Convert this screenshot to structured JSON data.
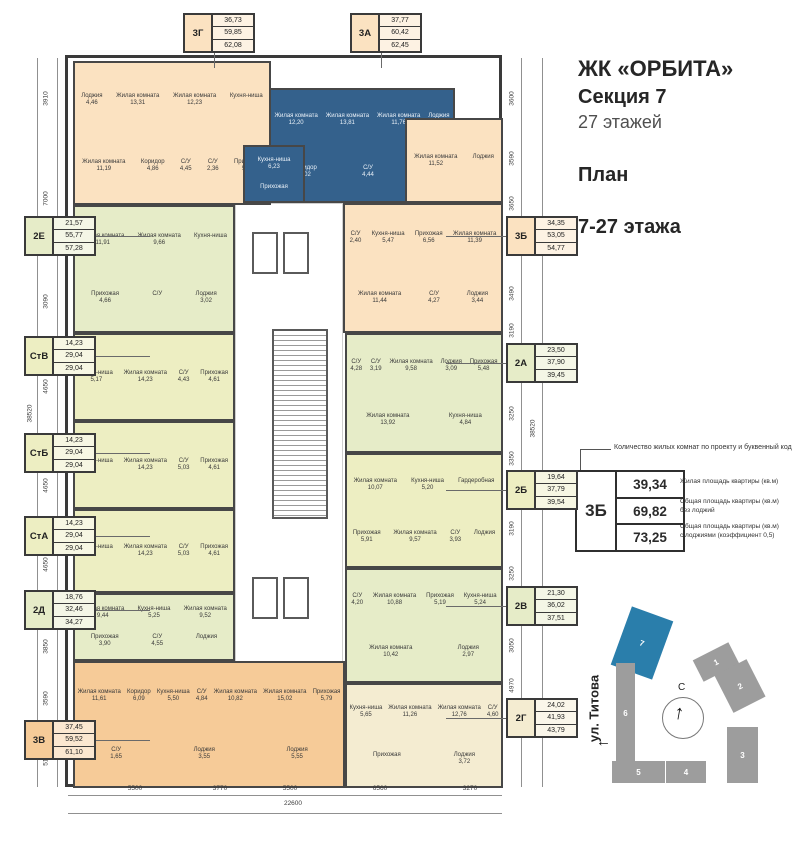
{
  "header": {
    "project": "ЖК «ОРБИТА»",
    "section": "Секция 7",
    "floors": "27 этажей",
    "plan_line1": "План",
    "plan_line2": "7-27 этажа"
  },
  "legend": {
    "note": "Количество жилых комнат по проекту и буквенный код",
    "code": "3Б",
    "rows": [
      {
        "value": "39,34",
        "desc": "Жилая площадь квартиры (кв.м)"
      },
      {
        "value": "69,82",
        "desc": "Общая площадь квартиры (кв.м)\nбез лоджий"
      },
      {
        "value": "73,25",
        "desc": "Общая площадь квартиры (кв.м)\nс лоджиями (коэффициент 0,5)"
      }
    ]
  },
  "colors": {
    "peach": "#fbe2c1",
    "blue": "#34618c",
    "green": "#e6ecc8",
    "studio": "#edeec2",
    "orange": "#f6cb98",
    "cream": "#f4ecd1"
  },
  "floor_plan": {
    "unit_labels": [
      {
        "code": "3Г",
        "values": [
          "36,73",
          "59,85",
          "62,08"
        ],
        "x": 183,
        "y": 13,
        "side": "top",
        "color": "peach"
      },
      {
        "code": "3А",
        "values": [
          "37,77",
          "60,42",
          "62,45"
        ],
        "x": 350,
        "y": 13,
        "side": "top",
        "color": "peach"
      },
      {
        "code": "2Е",
        "values": [
          "21,57",
          "55,77",
          "57,28"
        ],
        "x": 24,
        "y": 216,
        "side": "left",
        "color": "green"
      },
      {
        "code": "СтВ",
        "values": [
          "14,23",
          "29,04",
          "29,04"
        ],
        "x": 24,
        "y": 336,
        "side": "left",
        "color": "studio"
      },
      {
        "code": "СтБ",
        "values": [
          "14,23",
          "29,04",
          "29,04"
        ],
        "x": 24,
        "y": 433,
        "side": "left",
        "color": "studio"
      },
      {
        "code": "СтА",
        "values": [
          "14,23",
          "29,04",
          "29,04"
        ],
        "x": 24,
        "y": 516,
        "side": "left",
        "color": "studio"
      },
      {
        "code": "2Д",
        "values": [
          "18,76",
          "32,46",
          "34,27"
        ],
        "x": 24,
        "y": 590,
        "side": "left",
        "color": "green"
      },
      {
        "code": "3В",
        "values": [
          "37,45",
          "59,52",
          "61,10"
        ],
        "x": 24,
        "y": 720,
        "side": "left",
        "color": "orange"
      },
      {
        "code": "3Б",
        "values": [
          "34,35",
          "53,05",
          "54,77"
        ],
        "x": 506,
        "y": 216,
        "side": "right",
        "color": "peach"
      },
      {
        "code": "2А",
        "values": [
          "23,50",
          "37,90",
          "39,45"
        ],
        "x": 506,
        "y": 343,
        "side": "right",
        "color": "green"
      },
      {
        "code": "2Б",
        "values": [
          "19,64",
          "37,79",
          "39,54"
        ],
        "x": 506,
        "y": 470,
        "side": "right",
        "color": "studio"
      },
      {
        "code": "2В",
        "values": [
          "21,30",
          "36,02",
          "37,51"
        ],
        "x": 506,
        "y": 586,
        "side": "right",
        "color": "green"
      },
      {
        "code": "2Г",
        "values": [
          "24,02",
          "41,93",
          "43,79"
        ],
        "x": 506,
        "y": 698,
        "side": "right",
        "color": "cream"
      }
    ],
    "apartments": [
      {
        "code": "3Г",
        "color": "peach",
        "x": 5,
        "y": 3,
        "w": 198,
        "h": 144,
        "rooms": [
          {
            "n": "Лоджия",
            "a": "4,46"
          },
          {
            "n": "Жилая комната",
            "a": "13,31"
          },
          {
            "n": "Жилая комната",
            "a": "12,23"
          },
          {
            "n": "Кухня-ниша",
            "a": ""
          },
          {
            "n": "Жилая комната",
            "a": "11,19"
          },
          {
            "n": "Коридор",
            "a": "4,86"
          },
          {
            "n": "С/У",
            "a": "4,45"
          },
          {
            "n": "С/У",
            "a": "2,36"
          },
          {
            "n": "Прихожая",
            "a": "5,81"
          }
        ]
      },
      {
        "code": "3А",
        "color": "blue",
        "x": 201,
        "y": 30,
        "w": 186,
        "h": 115,
        "rooms": [
          {
            "n": "Жилая комната",
            "a": "12,20"
          },
          {
            "n": "Жилая комната",
            "a": "13,81"
          },
          {
            "n": "Жилая комната",
            "a": "11,76"
          },
          {
            "n": "Лоджия",
            "a": "4,01"
          },
          {
            "n": "Коридор",
            "a": "6,02"
          },
          {
            "n": "С/У",
            "a": "4,44"
          },
          {
            "n": "С/У",
            "a": "2,37"
          }
        ]
      },
      {
        "code": "3А",
        "color": "blue",
        "x": 175,
        "y": 87,
        "w": 62,
        "h": 58,
        "rooms": [
          {
            "n": "Кухня-ниша",
            "a": "6,23"
          },
          {
            "n": "Прихожая",
            "a": ""
          }
        ]
      },
      {
        "code": "3Б",
        "color": "peach",
        "x": 337,
        "y": 60,
        "w": 98,
        "h": 85,
        "rooms": [
          {
            "n": "Жилая комната",
            "a": "11,52"
          },
          {
            "n": "Лоджия",
            "a": ""
          }
        ]
      },
      {
        "code": "3Б",
        "color": "peach",
        "x": 275,
        "y": 145,
        "w": 160,
        "h": 130,
        "rooms": [
          {
            "n": "С/У",
            "a": "2,40"
          },
          {
            "n": "Кухня-ниша",
            "a": "5,47"
          },
          {
            "n": "Прихожая",
            "a": "6,56"
          },
          {
            "n": "Жилая комната",
            "a": "11,39"
          },
          {
            "n": "Жилая комната",
            "a": "11,44"
          },
          {
            "n": "С/У",
            "a": "4,27"
          },
          {
            "n": "Лоджия",
            "a": "3,44"
          }
        ]
      },
      {
        "code": "2Е",
        "color": "green",
        "x": 5,
        "y": 147,
        "w": 162,
        "h": 128,
        "rooms": [
          {
            "n": "Жилая комната",
            "a": "11,91"
          },
          {
            "n": "Жилая комната",
            "a": "9,66"
          },
          {
            "n": "Кухня-ниша",
            "a": ""
          },
          {
            "n": "Прихожая",
            "a": "4,66"
          },
          {
            "n": "С/У",
            "a": ""
          },
          {
            "n": "Лоджия",
            "a": "3,02"
          }
        ]
      },
      {
        "code": "СтВ",
        "color": "studio",
        "x": 5,
        "y": 275,
        "w": 162,
        "h": 88,
        "rooms": [
          {
            "n": "Кухня-ниша",
            "a": "5,17"
          },
          {
            "n": "Жилая комната",
            "a": "14,23"
          },
          {
            "n": "С/У",
            "a": "4,43"
          },
          {
            "n": "Прихожая",
            "a": "4,61"
          }
        ]
      },
      {
        "code": "СтБ",
        "color": "studio",
        "x": 5,
        "y": 363,
        "w": 162,
        "h": 88,
        "rooms": [
          {
            "n": "Кухня-ниша",
            "a": ""
          },
          {
            "n": "Жилая комната",
            "a": "14,23"
          },
          {
            "n": "С/У",
            "a": "5,03"
          },
          {
            "n": "Прихожая",
            "a": "4,61"
          }
        ]
      },
      {
        "code": "СтА",
        "color": "studio",
        "x": 5,
        "y": 451,
        "w": 162,
        "h": 84,
        "rooms": [
          {
            "n": "Кухня-ниша",
            "a": ""
          },
          {
            "n": "Жилая комната",
            "a": "14,23"
          },
          {
            "n": "С/У",
            "a": "5,03"
          },
          {
            "n": "Прихожая",
            "a": "4,61"
          }
        ]
      },
      {
        "code": "2Д",
        "color": "green",
        "x": 5,
        "y": 535,
        "w": 162,
        "h": 68,
        "rooms": [
          {
            "n": "Жилая комната",
            "a": "9,44"
          },
          {
            "n": "Кухня-ниша",
            "a": "5,25"
          },
          {
            "n": "Жилая комната",
            "a": "9,52"
          },
          {
            "n": "Прихожая",
            "a": "3,90"
          },
          {
            "n": "С/У",
            "a": "4,55"
          },
          {
            "n": "Лоджия",
            "a": ""
          }
        ]
      },
      {
        "code": "3В",
        "color": "orange",
        "x": 5,
        "y": 603,
        "w": 272,
        "h": 127,
        "rooms": [
          {
            "n": "Жилая комната",
            "a": "11,61"
          },
          {
            "n": "Коридор",
            "a": "6,09"
          },
          {
            "n": "Кухня-ниша",
            "a": "5,50"
          },
          {
            "n": "С/У",
            "a": "4,84"
          },
          {
            "n": "Жилая комната",
            "a": "10,82"
          },
          {
            "n": "Жилая комната",
            "a": "15,02"
          },
          {
            "n": "Прихожая",
            "a": "5,79"
          },
          {
            "n": "С/У",
            "a": "1,65"
          },
          {
            "n": "Лоджия",
            "a": "3,55"
          },
          {
            "n": "Лоджия",
            "a": "5,55"
          }
        ]
      },
      {
        "code": "2Г",
        "color": "cream",
        "x": 277,
        "y": 625,
        "w": 158,
        "h": 105,
        "rooms": [
          {
            "n": "Кухня-ниша",
            "a": "5,65"
          },
          {
            "n": "Жилая комната",
            "a": "11,26"
          },
          {
            "n": "Жилая комната",
            "a": "12,76"
          },
          {
            "n": "С/У",
            "a": "4,60"
          },
          {
            "n": "Прихожая",
            "a": ""
          },
          {
            "n": "Лоджия",
            "a": "3,72"
          }
        ]
      },
      {
        "code": "2В",
        "color": "green",
        "x": 277,
        "y": 510,
        "w": 158,
        "h": 115,
        "rooms": [
          {
            "n": "С/У",
            "a": "4,20"
          },
          {
            "n": "Жилая комната",
            "a": "10,88"
          },
          {
            "n": "Прихожая",
            "a": "5,19"
          },
          {
            "n": "Кухня-ниша",
            "a": "5,24"
          },
          {
            "n": "Жилая комната",
            "a": "10,42"
          },
          {
            "n": "Лоджия",
            "a": "2,97"
          }
        ]
      },
      {
        "code": "2Б",
        "color": "studio",
        "x": 277,
        "y": 395,
        "w": 158,
        "h": 115,
        "rooms": [
          {
            "n": "Жилая комната",
            "a": "10,07"
          },
          {
            "n": "Кухня-ниша",
            "a": "5,20"
          },
          {
            "n": "Гардеробная",
            "a": ""
          },
          {
            "n": "Прихожая",
            "a": "5,91"
          },
          {
            "n": "Жилая комната",
            "a": "9,57"
          },
          {
            "n": "С/У",
            "a": "3,93"
          },
          {
            "n": "Лоджия",
            "a": ""
          }
        ]
      },
      {
        "code": "2А",
        "color": "green",
        "x": 277,
        "y": 275,
        "w": 158,
        "h": 120,
        "rooms": [
          {
            "n": "С/У",
            "a": "4,28"
          },
          {
            "n": "С/У",
            "a": "3,19"
          },
          {
            "n": "Жилая комната",
            "a": "9,58"
          },
          {
            "n": "Лоджия",
            "a": "3,09"
          },
          {
            "n": "Прихожая",
            "a": "5,48"
          },
          {
            "n": "Жилая комната",
            "a": "13,92"
          },
          {
            "n": "Кухня-ниша",
            "a": "4,84"
          }
        ]
      }
    ],
    "dims": {
      "left": [
        {
          "v": "3910",
          "y": 100
        },
        {
          "v": "7000",
          "y": 200
        },
        {
          "v": "3090",
          "y": 303
        },
        {
          "v": "4650",
          "y": 388
        },
        {
          "v": "4650",
          "y": 487
        },
        {
          "v": "4650",
          "y": 566
        },
        {
          "v": "3850",
          "y": 648
        },
        {
          "v": "3590",
          "y": 700
        },
        {
          "v": "5190",
          "y": 760
        }
      ],
      "right": [
        {
          "v": "3600",
          "y": 100
        },
        {
          "v": "3590",
          "y": 160
        },
        {
          "v": "3650",
          "y": 205
        },
        {
          "v": "3490",
          "y": 295
        },
        {
          "v": "3190",
          "y": 332
        },
        {
          "v": "3250",
          "y": 415
        },
        {
          "v": "3350",
          "y": 460
        },
        {
          "v": "3190",
          "y": 530
        },
        {
          "v": "3250",
          "y": 575
        },
        {
          "v": "3050",
          "y": 647
        },
        {
          "v": "4970",
          "y": 687
        }
      ],
      "bottom": [
        {
          "v": "5500",
          "x": 135
        },
        {
          "v": "3770",
          "x": 220
        },
        {
          "v": "5500",
          "x": 290
        },
        {
          "v": "6560",
          "x": 380
        },
        {
          "v": "3270",
          "x": 470
        }
      ],
      "left_total": "38520",
      "right_total": "38520",
      "bottom_total": "22600"
    }
  },
  "site_plan": {
    "street": "ул. Титова",
    "north": "С",
    "highlighted": "7",
    "buildings": [
      {
        "n": "7",
        "x": 620,
        "y": 612,
        "w": 44,
        "h": 62,
        "r": 20,
        "hl": true
      },
      {
        "n": "6",
        "x": 616,
        "y": 663,
        "w": 19,
        "h": 100,
        "r": 0,
        "hl": false
      },
      {
        "n": "5",
        "x": 612,
        "y": 761,
        "w": 53,
        "h": 22,
        "r": 0,
        "hl": false
      },
      {
        "n": "4",
        "x": 666,
        "y": 761,
        "w": 40,
        "h": 22,
        "r": 0,
        "hl": false
      },
      {
        "n": "1",
        "x": 696,
        "y": 650,
        "w": 40,
        "h": 24,
        "r": -27,
        "hl": false
      },
      {
        "n": "2",
        "x": 722,
        "y": 665,
        "w": 36,
        "h": 42,
        "r": -27,
        "hl": false
      },
      {
        "n": "3",
        "x": 727,
        "y": 727,
        "w": 31,
        "h": 56,
        "r": 0,
        "hl": false
      }
    ]
  }
}
